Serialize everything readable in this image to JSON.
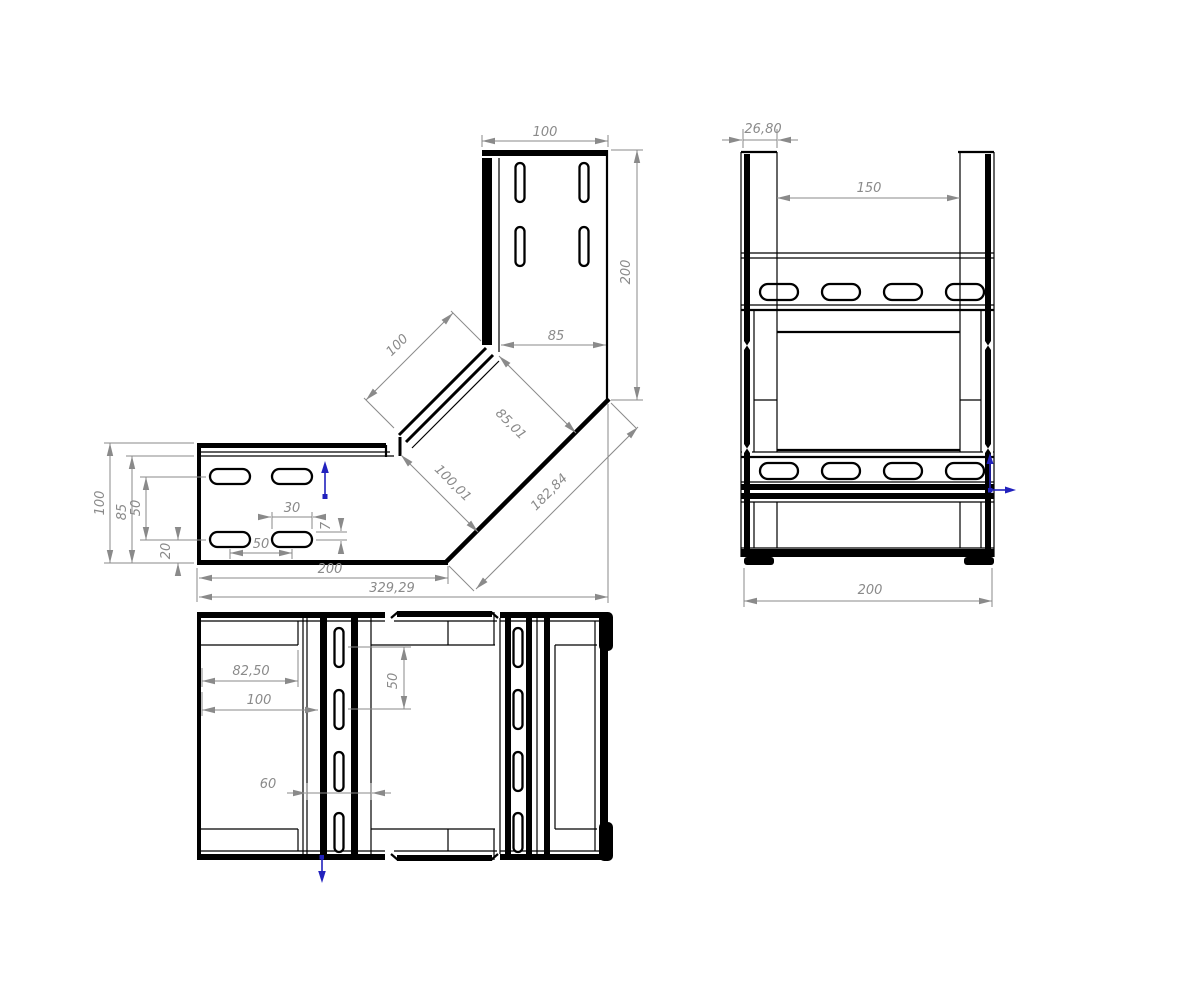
{
  "drawing": {
    "background_color": "#ffffff",
    "line_color": "#000000",
    "dim_color": "#8a8a8a",
    "accent_color": "#2121bd",
    "views": {
      "side": {
        "dims": {
          "top_width": "100",
          "right_height": "200",
          "inner_width": "85",
          "chamfer_length": "100",
          "diag_width_inner": "85,01",
          "diag_width_outer": "100,01",
          "outer_diagonal": "182,84",
          "left_height": "100",
          "left_inner_height": "85",
          "slot_row_pitch": "50",
          "slot_bottom_offset": "20",
          "slot_length": "30",
          "slot_offset": "7",
          "slot_spacing": "50",
          "arm_length": "200",
          "overall_length": "329,29"
        }
      },
      "front": {
        "dims": {
          "rail_width": "26,80",
          "inner_width": "150",
          "overall_width": "200"
        }
      },
      "plan": {
        "dims": {
          "end_to_fold": "82,50",
          "end_to_band": "100",
          "slot_row_pitch": "50",
          "band_width": "60"
        }
      }
    },
    "markers": {
      "side_marker": "up-arrow",
      "front_marker": "right-arrow",
      "plan_marker": "down-arrow"
    }
  }
}
